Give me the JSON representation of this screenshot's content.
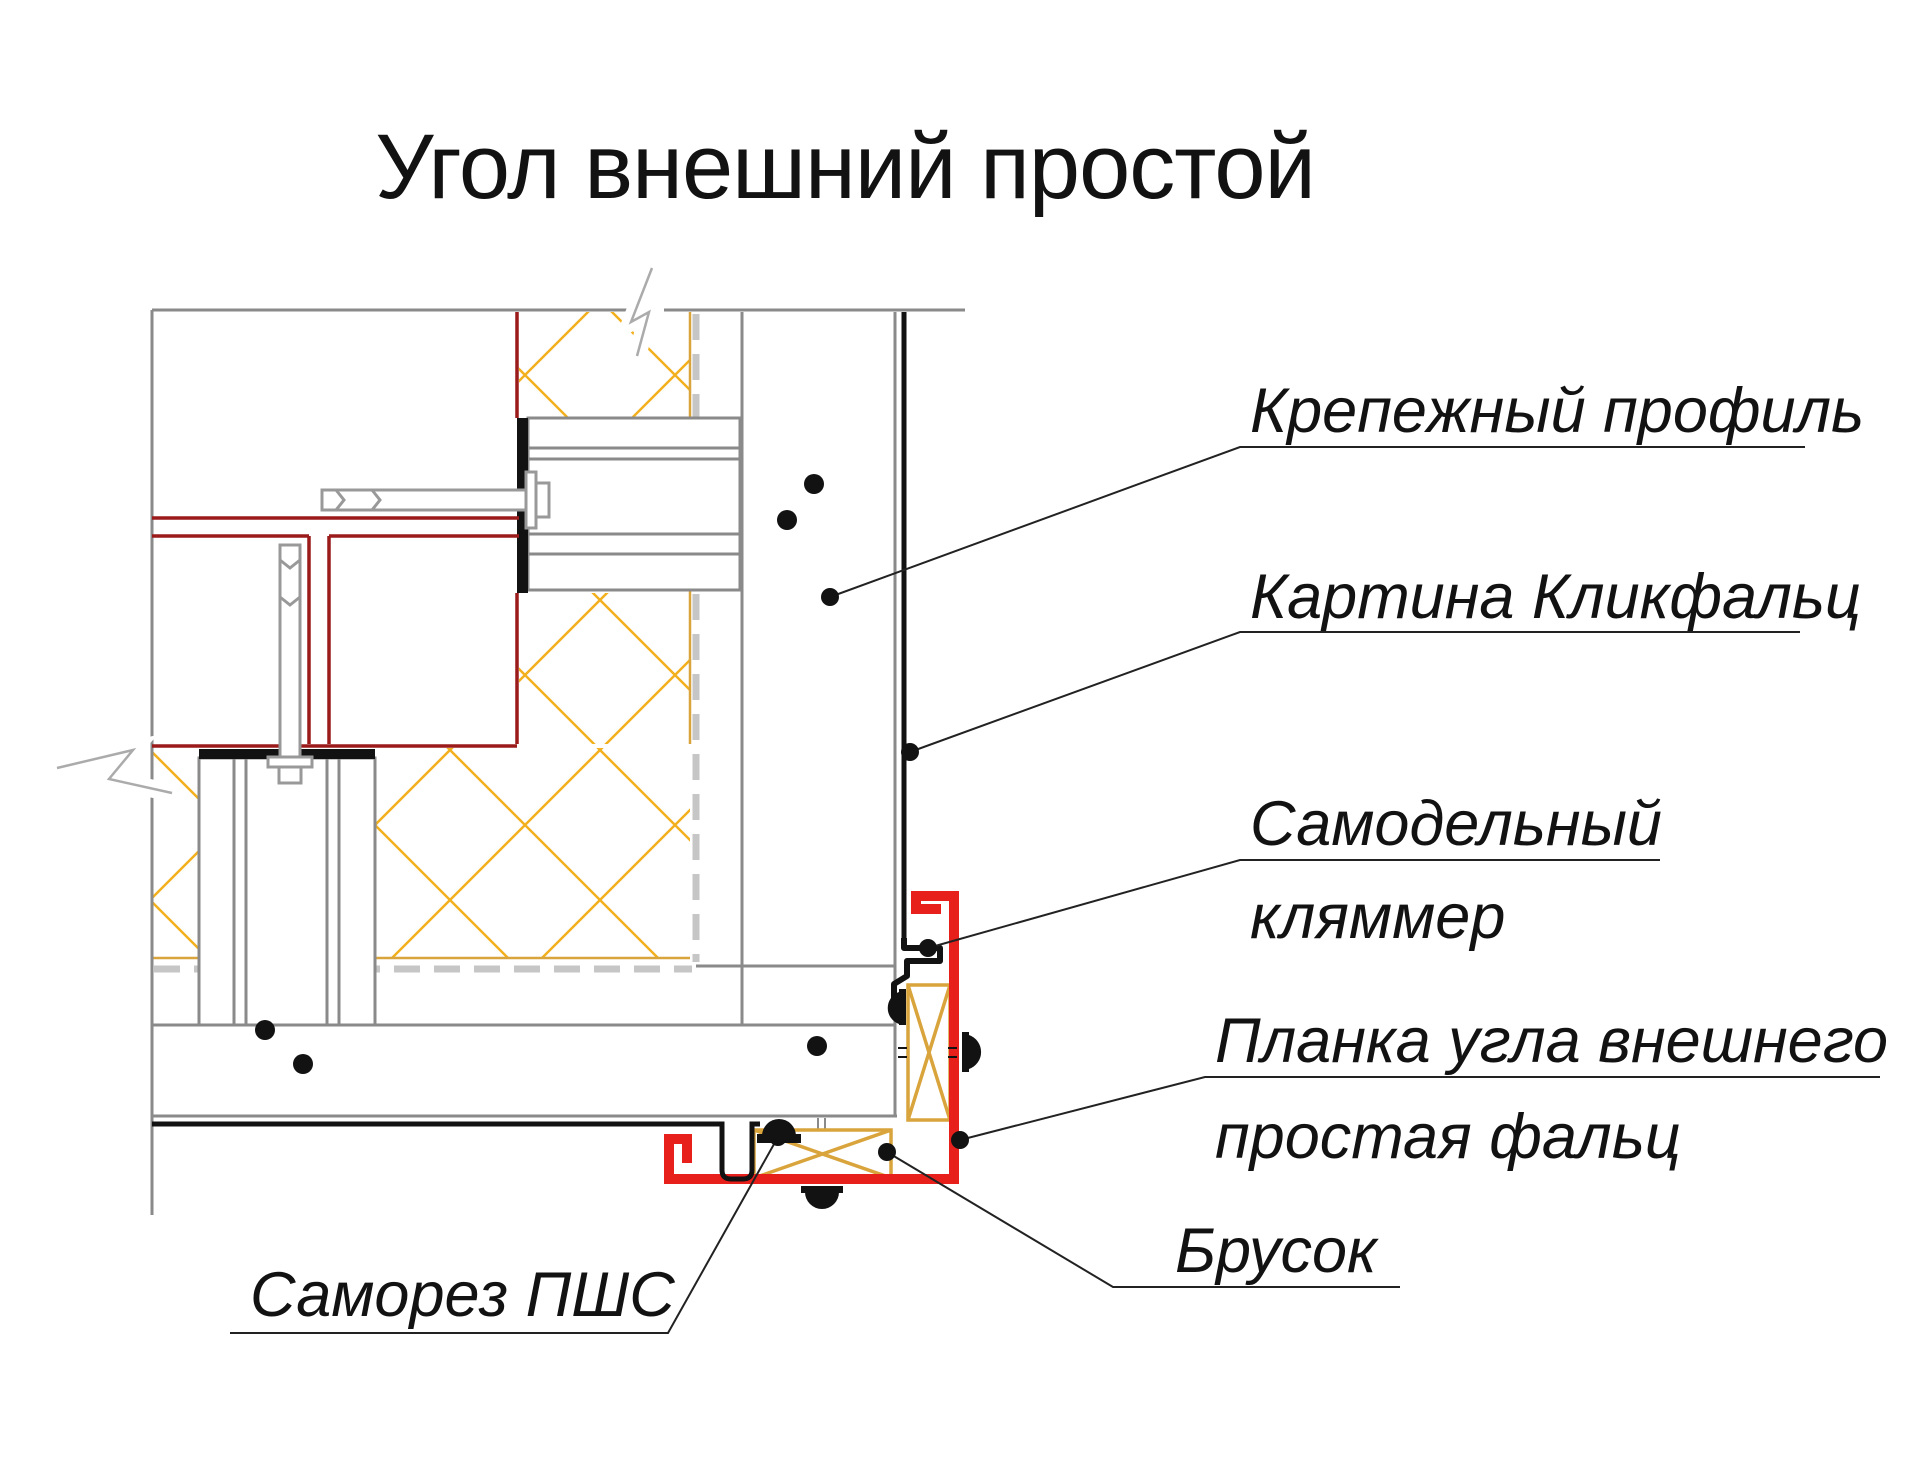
{
  "title": "Угол внешний простой",
  "labels": {
    "fixing_profile": "Крепежный профиль",
    "panel": "Картина Кликфальц",
    "klammer_line1": "Самодельный",
    "klammer_line2": "кляммер",
    "corner_strip_line1": "Планка угла внешнего",
    "corner_strip_line2": "простая фальц",
    "block": "Брусок",
    "screw": "Саморез ПШС"
  },
  "colors": {
    "accent_red": "#e8201c",
    "dark_red": "#9b1a1a",
    "insulation_yellow": "#f2b01e",
    "wood_tan": "#d9a43c",
    "line_gray": "#8a8a8a",
    "membrane_gray": "#c6c6c6",
    "ink_black": "#121212",
    "leader_black": "#222222"
  }
}
